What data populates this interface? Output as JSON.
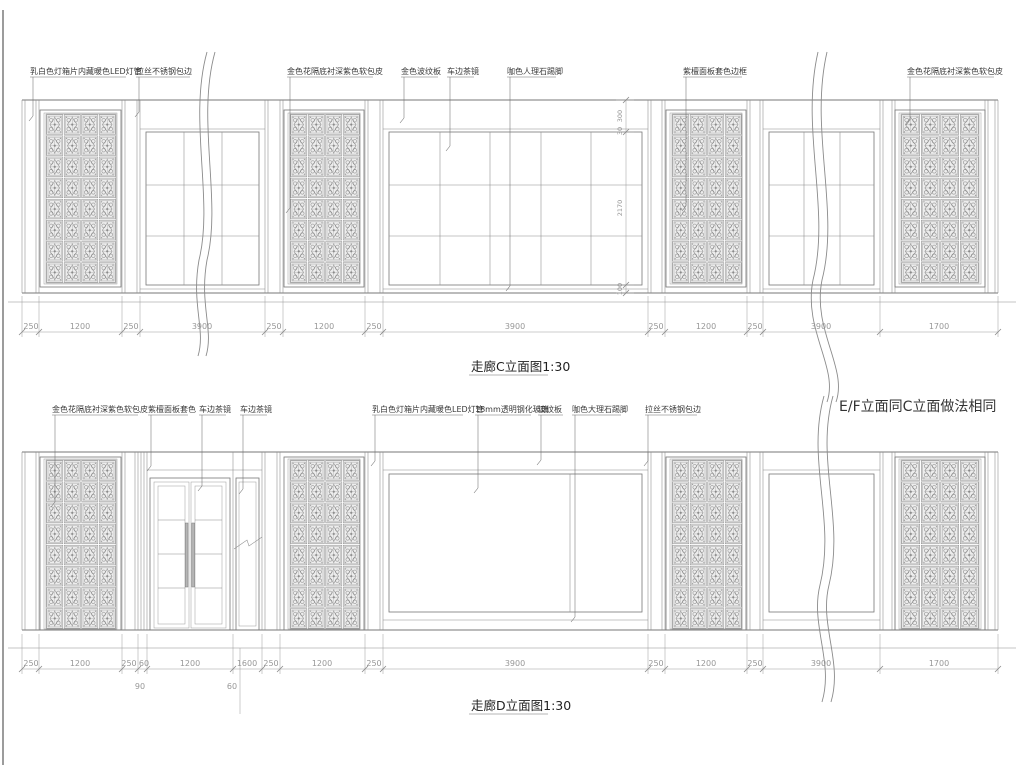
{
  "sheet": {
    "background": "#ffffff",
    "line_color": "#777777",
    "dim_color": "#979797",
    "text_color": "#3a3a3a"
  },
  "elevation_c": {
    "title": "走廊C立面图1:30",
    "labels": [
      "乳白色灯箱片内藏暖色LED灯管",
      "拉丝不锈钢包边",
      "金色花隔底衬深紫色软包皮",
      "金色波纹板",
      "车边茶镜",
      "咖色人理石踢脚",
      "紫檀面板套色边框",
      "金色花隔底衬深紫色软包皮"
    ],
    "dims": [
      "250",
      "1200",
      "250",
      "3900",
      "250",
      "1200",
      "250",
      "3900",
      "250",
      "1200",
      "250",
      "3900",
      "1700"
    ],
    "vdims": [
      "300",
      "30",
      "2170",
      "100"
    ]
  },
  "elevation_d": {
    "title": "走廊D立面图1:30",
    "note": "E/F立面同C立面做法相同",
    "labels": [
      "金色花隔底衬深紫色软包皮",
      "紫檀面板套色",
      "车边茶镜",
      "车边茶镜",
      "乳白色灯箱片内藏暖色LED灯管",
      "18mm透明钢化玻璃",
      "波纹板",
      "咖色大理石踢脚",
      "拉丝不锈钢包边"
    ],
    "dims": [
      "250",
      "1200",
      "250",
      "60",
      "1200",
      "1600",
      "250",
      "1200",
      "250",
      "3900",
      "250",
      "1200",
      "250",
      "3900",
      "1700"
    ],
    "subdims": [
      "90",
      "60"
    ]
  }
}
